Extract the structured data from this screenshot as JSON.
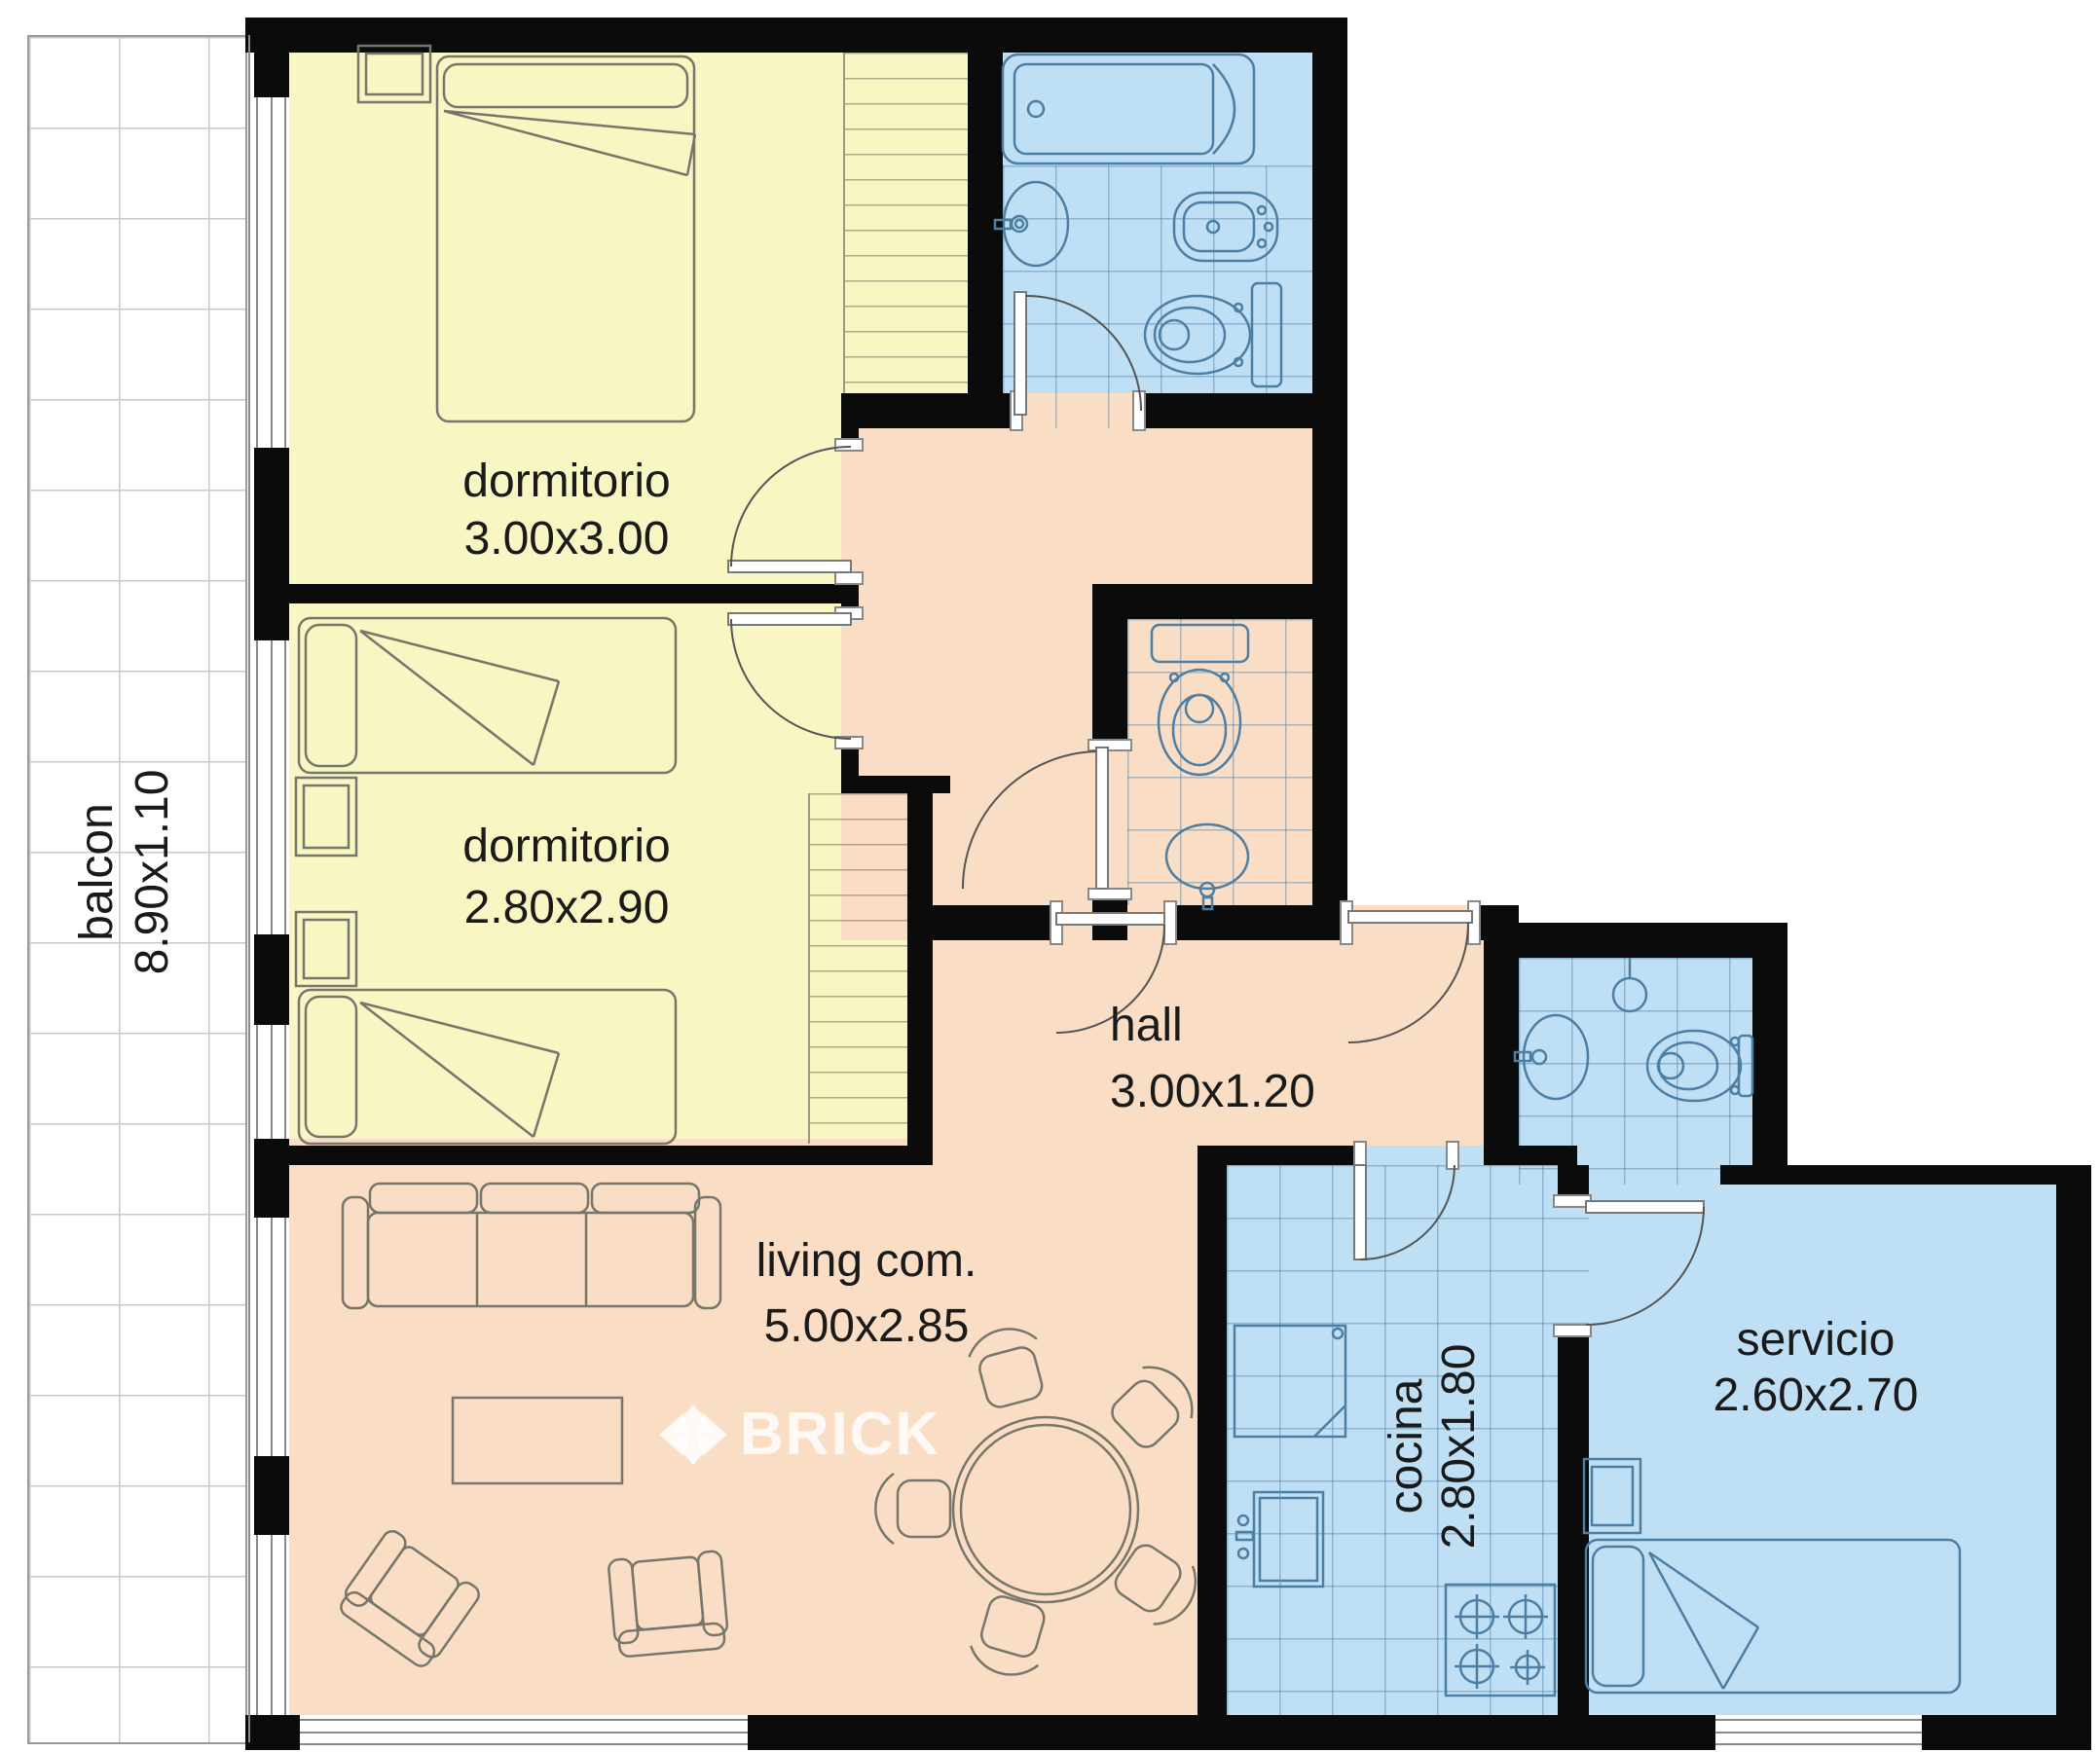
{
  "plan": {
    "title": "apartment floor plan",
    "watermark": "BRICK",
    "palette": {
      "wall": "#0b0b0b",
      "bedroom": "#f8f6c2",
      "wet": "#bfe0f4",
      "social": "#f9dec5",
      "balcony": "#ffffff",
      "text": "#1a1a1a"
    },
    "rooms": [
      {
        "id": "balcon",
        "label": "balcon",
        "dims": "8.90x1.10"
      },
      {
        "id": "dormitorio-1",
        "label": "dormitorio",
        "dims": "3.00x3.00"
      },
      {
        "id": "dormitorio-2",
        "label": "dormitorio",
        "dims": "2.80x2.90"
      },
      {
        "id": "hall",
        "label": "hall",
        "dims": "3.00x1.20"
      },
      {
        "id": "living",
        "label": "living com.",
        "dims": "5.00x2.85"
      },
      {
        "id": "cocina",
        "label": "cocina",
        "dims": "2.80x1.80"
      },
      {
        "id": "servicio",
        "label": "servicio",
        "dims": "2.60x2.70"
      }
    ]
  }
}
